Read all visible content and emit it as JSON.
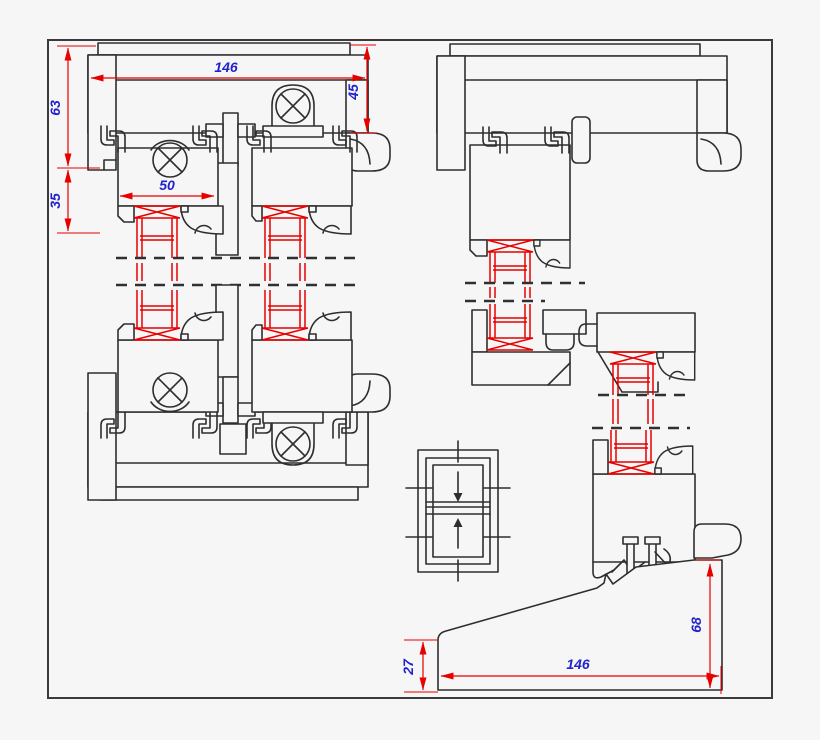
{
  "drawing": {
    "colors": {
      "background": "#f6f6f6",
      "profile_line": "#2e2e2e",
      "dimension_line": "#e60000",
      "glass_line": "#e60000",
      "label_text": "#2222cc"
    },
    "dimensions": {
      "head_overall_width": "146",
      "head_channel_height": "45",
      "frame_leg_height": "63",
      "sash_projection": "35",
      "sash_width": "50",
      "sill_front_height": "27",
      "sill_overall_width": "146",
      "sill_back_height": "68"
    }
  }
}
